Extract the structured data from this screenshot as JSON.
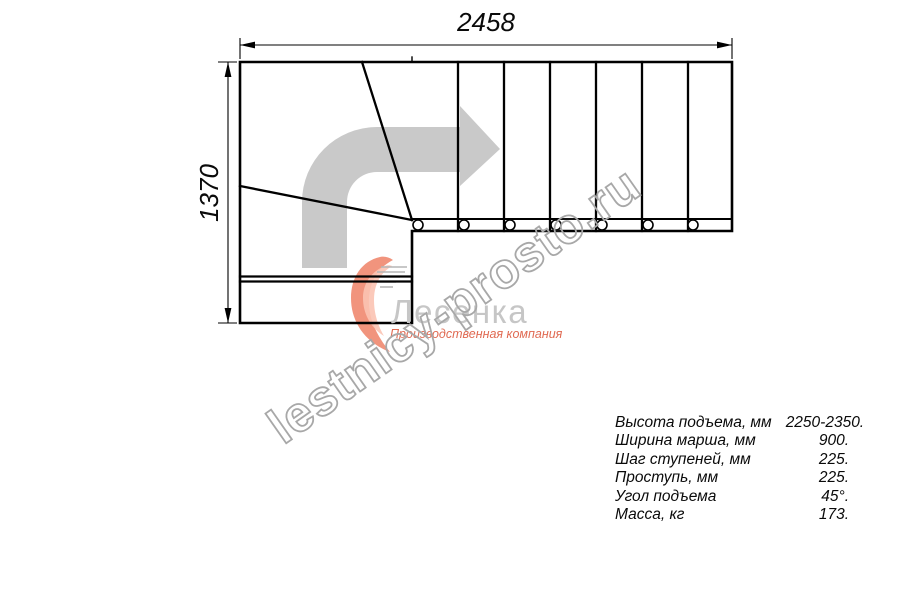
{
  "drawing": {
    "title_semantic": "L-shaped staircase plan, top view",
    "width_dimension_label": "2458",
    "height_dimension_label": "1370",
    "straight_flight_treads": 7,
    "winder_treads": 3,
    "baluster_count": 7,
    "colors": {
      "line": "#000000",
      "direction_arrow": "#c9c9c9"
    }
  },
  "watermark": {
    "text": "lestnicy-prosto.ru",
    "color": "#a8a8a8"
  },
  "logo": {
    "brand": "Лесенка",
    "tagline": "Производственная компания",
    "brand_color": "#c6c6c6",
    "accent_color": "#ef8166"
  },
  "specs": {
    "rows": [
      {
        "label": "Высота подъема, мм",
        "value": "2250-2350."
      },
      {
        "label": "Ширина марша, мм",
        "value": "900."
      },
      {
        "label": "Шаг ступеней, мм",
        "value": "225."
      },
      {
        "label": "Проступь, мм",
        "value": "225."
      },
      {
        "label": "Угол подъема",
        "value": "45°."
      },
      {
        "label": "Масса, кг",
        "value": "173."
      }
    ]
  }
}
